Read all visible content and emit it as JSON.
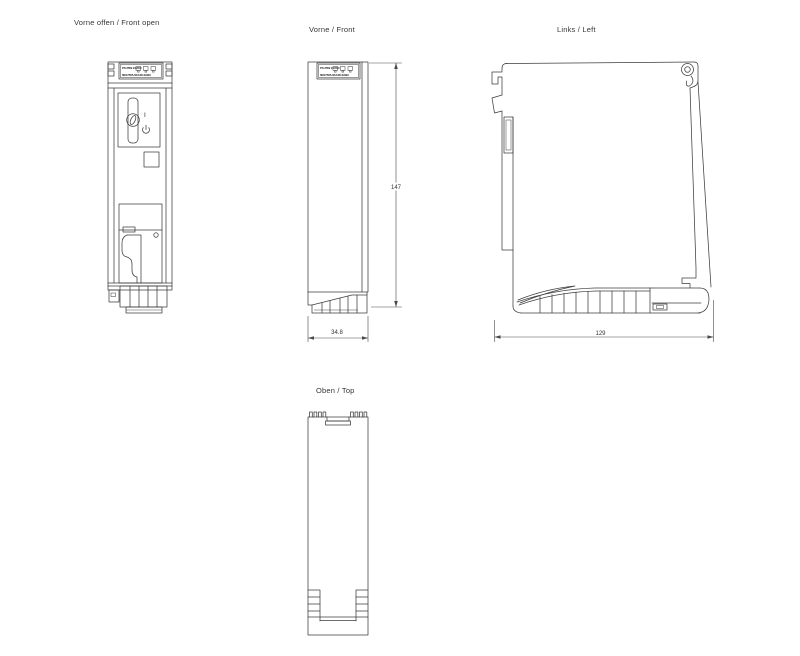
{
  "drawing": {
    "type": "technical-dimension-drawing",
    "units": "mm",
    "line_color": "#3d3d3d",
    "background_color": "#ffffff"
  },
  "views": {
    "front_open": {
      "label": "Vorne offen / Front open"
    },
    "front": {
      "label": "Vorne / Front",
      "dim_height": "147",
      "dim_width": "34.8"
    },
    "left": {
      "label": "Links / Left",
      "dim_depth": "129"
    },
    "top": {
      "label": "Oben / Top"
    }
  },
  "module": {
    "nameplate_line1": "PS 25W 24VDC",
    "nameplate_line2": "6ES7505-0KA00-0AB0",
    "power_on_label": "I"
  }
}
